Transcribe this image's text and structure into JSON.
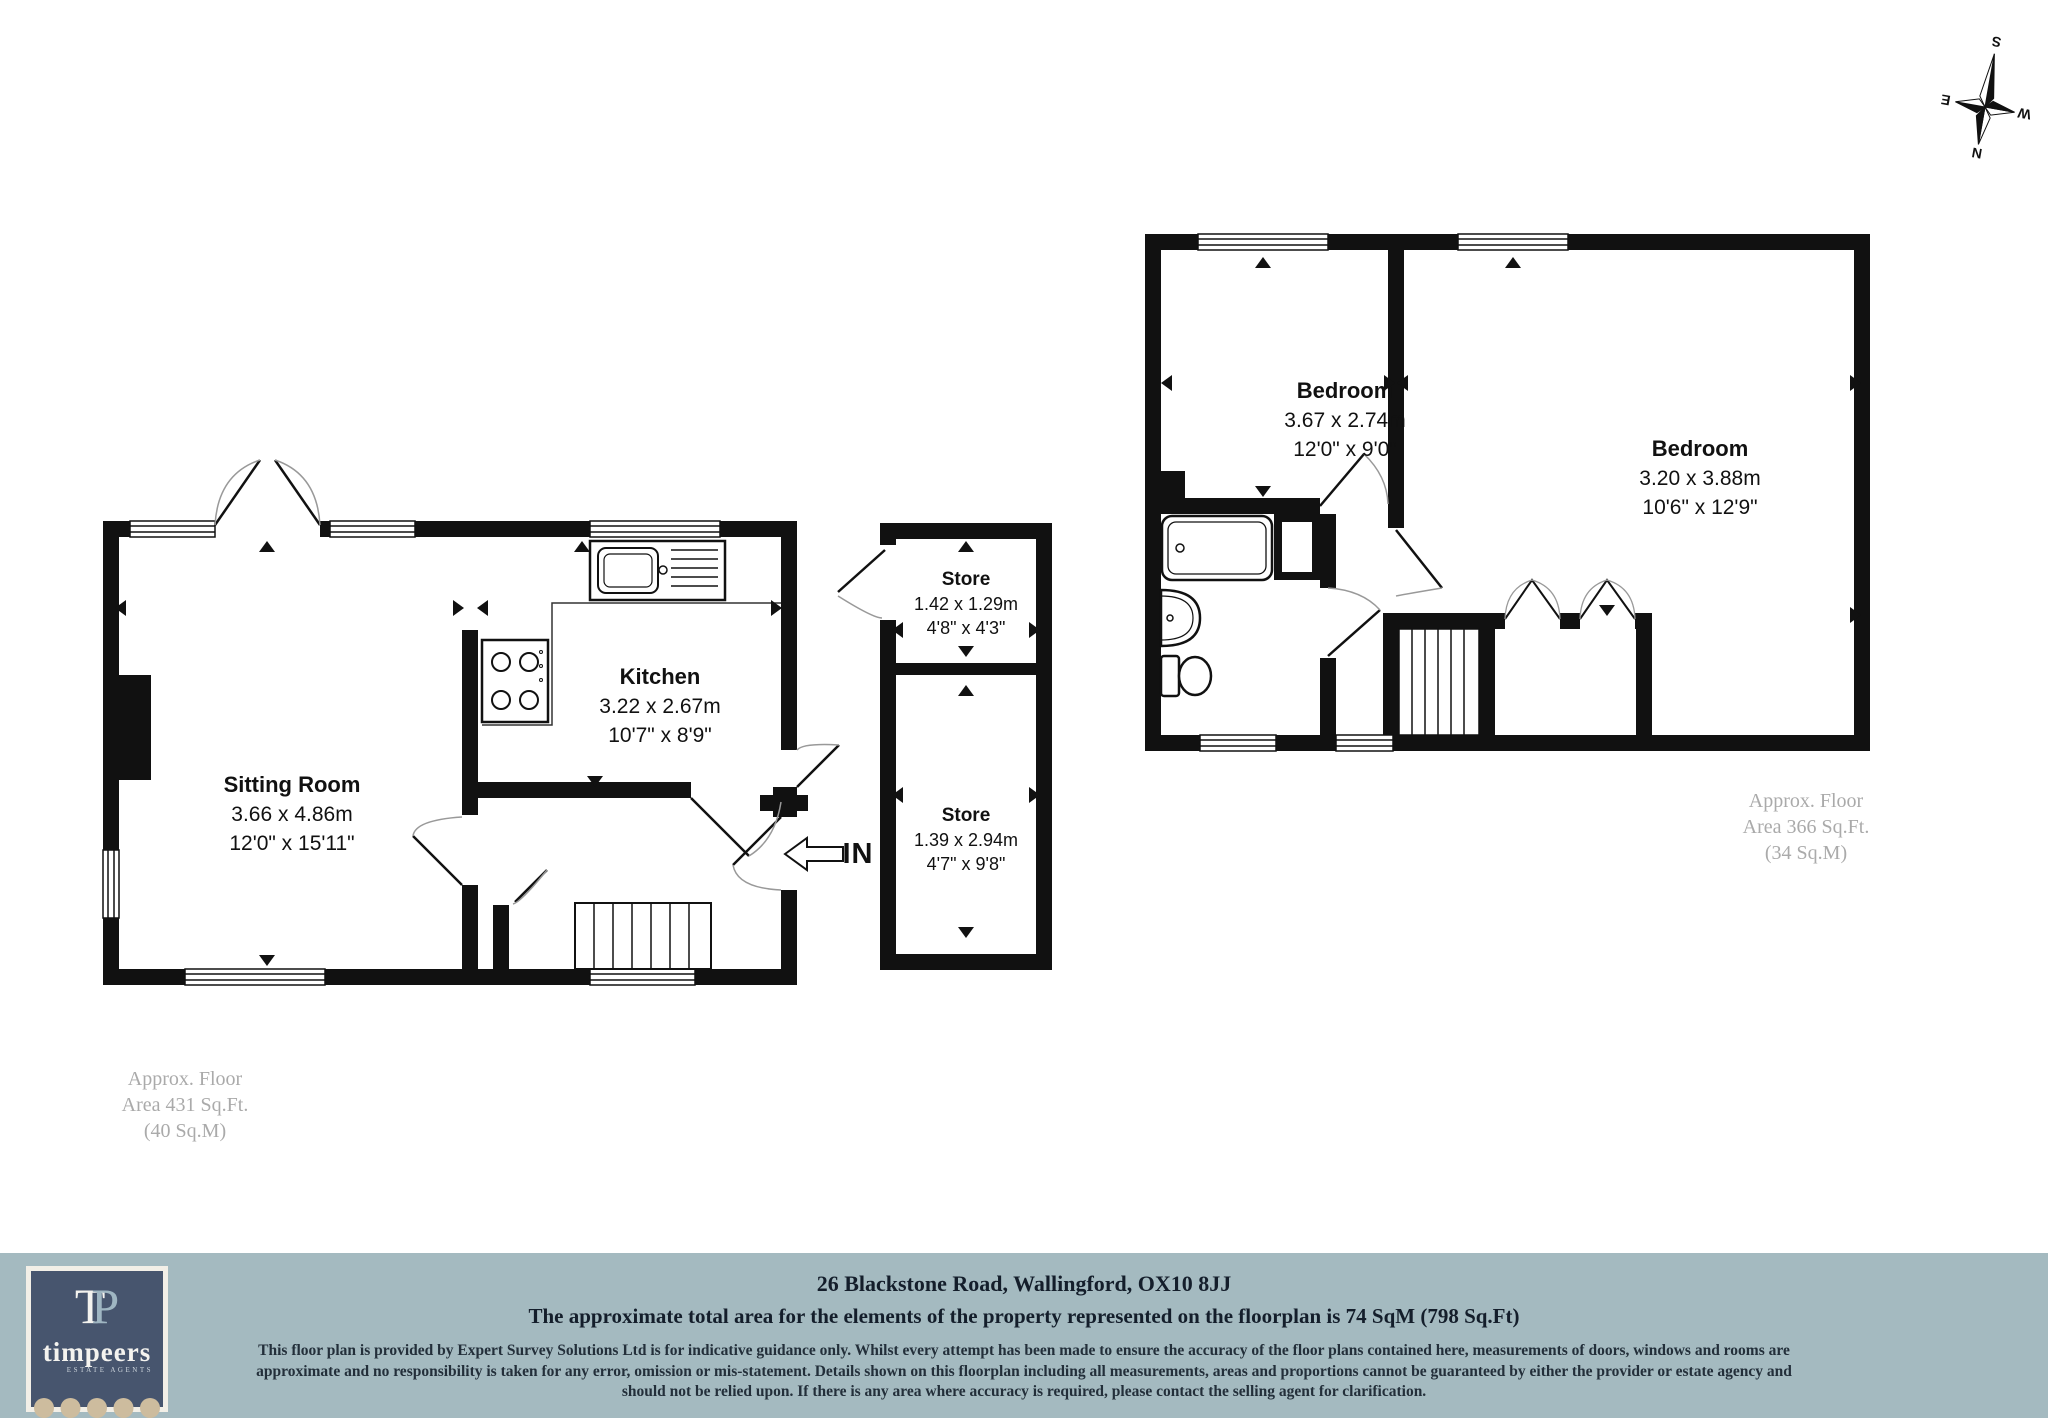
{
  "compass": {
    "n": "N",
    "s": "S",
    "e": "E",
    "w": "W"
  },
  "ground_floor": {
    "rooms": [
      {
        "name": "Sitting Room",
        "metric": "3.66 x 4.86m",
        "imperial": "12'0\" x 15'11\""
      },
      {
        "name": "Kitchen",
        "metric": "3.22 x 2.67m",
        "imperial": "10'7\" x 8'9\""
      },
      {
        "name": "Store",
        "metric": "1.42 x 1.29m",
        "imperial": "4'8\" x 4'3\""
      },
      {
        "name": "Store",
        "metric": "1.39 x 2.94m",
        "imperial": "4'7\" x 9'8\""
      }
    ],
    "entrance_label": "IN",
    "area_note": {
      "line1": "Approx. Floor",
      "line2": "Area 431 Sq.Ft.",
      "line3": "(40 Sq.M)"
    }
  },
  "first_floor": {
    "rooms": [
      {
        "name": "Bedroom",
        "metric": "3.67 x 2.74m",
        "imperial": "12'0\" x 9'0\""
      },
      {
        "name": "Bedroom",
        "metric": "3.20 x 3.88m",
        "imperial": "10'6\" x 12'9\""
      }
    ],
    "area_note": {
      "line1": "Approx. Floor",
      "line2": "Area 366 Sq.Ft.",
      "line3": "(34 Sq.M)"
    }
  },
  "footer": {
    "address": "26 Blackstone Road, Wallingford, OX10 8JJ",
    "total_area": "The approximate total area for the elements of the property represented on the floorplan is 74 SqM (798 Sq.Ft)",
    "disclaimer": "This floor plan is provided by Expert Survey Solutions Ltd is for indicative guidance only. Whilst every attempt has been made to ensure the accuracy of the floor plans contained here, measurements of doors, windows and rooms are approximate and no responsibility is taken for any error, omission or mis-statement. Details shown on this floorplan including all measurements, areas and proportions cannot be guaranteed by either the provider or estate agency and should not be relied upon.  If there is any area where accuracy is required, please contact the selling agent for clarification.",
    "logo": {
      "monogram_t": "T",
      "monogram_p": "P",
      "name": "timpeers",
      "tagline": "ESTATE AGENTS"
    }
  },
  "colors": {
    "plan_line": "#111111",
    "footer_band": "#a4bac0",
    "logo_navy": "#47556e",
    "logo_beige": "#cdbc9e",
    "area_text_gray": "#aaaaaa"
  }
}
